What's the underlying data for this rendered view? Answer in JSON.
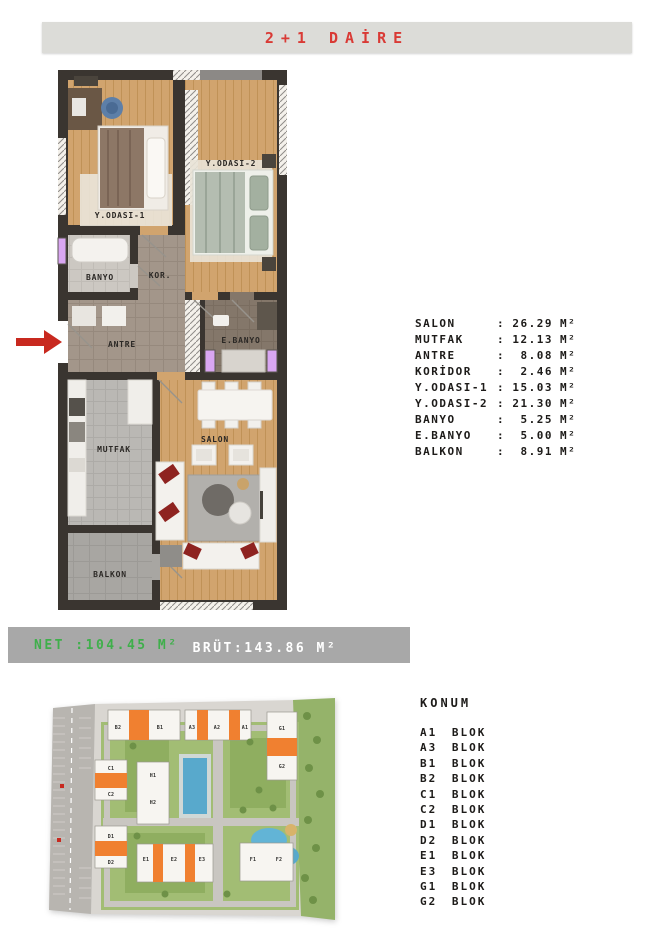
{
  "header": {
    "title": "2+1 DAİRE",
    "text_color": "#d93a35",
    "bar_color": "#dcdcd8"
  },
  "floor_plan": {
    "rooms": {
      "bedroom1": "Y.ODASI-1",
      "bedroom2": "Y.ODASI-2",
      "banyo": "BANYO",
      "koridor": "KOR.",
      "antre": "ANTRE",
      "ebanyo": "E.BANYO",
      "mutfak": "MUTFAK",
      "salon": "SALON",
      "balkon": "BALKON"
    },
    "entrance_arrow_color": "#c8291f"
  },
  "areas": {
    "sep": ":",
    "rows": [
      {
        "label": "SALON",
        "value": "26.29",
        "unit": "M²"
      },
      {
        "label": "MUTFAK",
        "value": "12.13",
        "unit": "M²"
      },
      {
        "label": "ANTRE",
        "value": "8.08",
        "unit": "M²"
      },
      {
        "label": "KORİDOR",
        "value": "2.46",
        "unit": "M²"
      },
      {
        "label": "Y.ODASI-1",
        "value": "15.03",
        "unit": "M²"
      },
      {
        "label": "Y.ODASI-2",
        "value": "21.30",
        "unit": "M²"
      },
      {
        "label": "BANYO",
        "value": "5.25",
        "unit": "M²"
      },
      {
        "label": "E.BANYO",
        "value": "5.00",
        "unit": "M²"
      },
      {
        "label": "BALKON",
        "value": "8.91",
        "unit": "M²"
      }
    ]
  },
  "summary": {
    "net_text": "NET :104.45 M²",
    "brut_text": "BRÜT:143.86 M²",
    "net_color": "#3faf4b",
    "brut_color": "#ffffff",
    "bar_color": "#a8a8a8"
  },
  "konum": {
    "title": "KONUM",
    "blocks": [
      "A1 BLOK",
      "A3 BLOK",
      "B1 BLOK",
      "B2 BLOK",
      "C1 BLOK",
      "C2 BLOK",
      "D1 BLOK",
      "D2 BLOK",
      "E1 BLOK",
      "E3 BLOK",
      "G1 BLOK",
      "G2 BLOK"
    ]
  },
  "site_plan": {
    "highlight_color": "#f08030",
    "block_labels": [
      "B2",
      "B1",
      "A3",
      "A2",
      "A1",
      "G1",
      "G2",
      "C1",
      "C2",
      "H1",
      "H2",
      "D1",
      "D2",
      "E1",
      "E2",
      "E3",
      "F1",
      "F2"
    ]
  }
}
